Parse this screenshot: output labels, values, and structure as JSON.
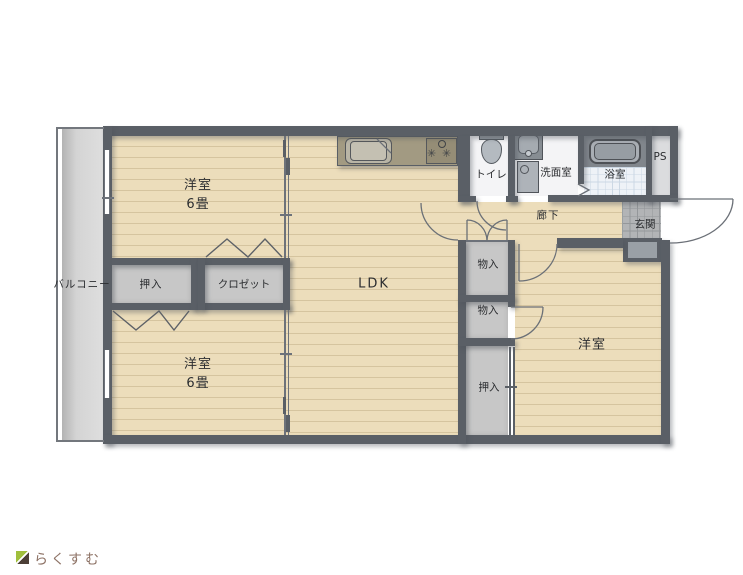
{
  "labels": {
    "balcony": "バルコニー",
    "bedroom_tl": "洋室",
    "bedroom_tl_size": "6畳",
    "bedroom_bl": "洋室",
    "bedroom_bl_size": "6畳",
    "ldk": "LDK",
    "toilet": "トイレ",
    "washroom": "洗面室",
    "bathroom": "浴室",
    "ps": "PS",
    "hallway": "廊下",
    "entrance": "玄関",
    "storage_upper": "物入",
    "storage_lower": "物入",
    "oshiire_left": "押入",
    "oshiire_right": "押入",
    "closet": "クロゼット",
    "bedroom_right": "洋室"
  },
  "logo": {
    "text": "らくすむ"
  },
  "colors": {
    "wall": "#5a5f66",
    "wood_floor": "#ecddbb",
    "wood_line": "#d5c49f",
    "closet_fill": "#c7c7c7",
    "balcony_floor": "#cfcfcf",
    "entrance_tile": "#b2b4b6",
    "bath_floor": "#eef2f7",
    "sanitary_floor": "#f4f4f6",
    "counter": "#a29a82",
    "logo_text": "#8d7265",
    "logo_green": "#a0bf3c",
    "logo_dark": "#4c3f37"
  }
}
